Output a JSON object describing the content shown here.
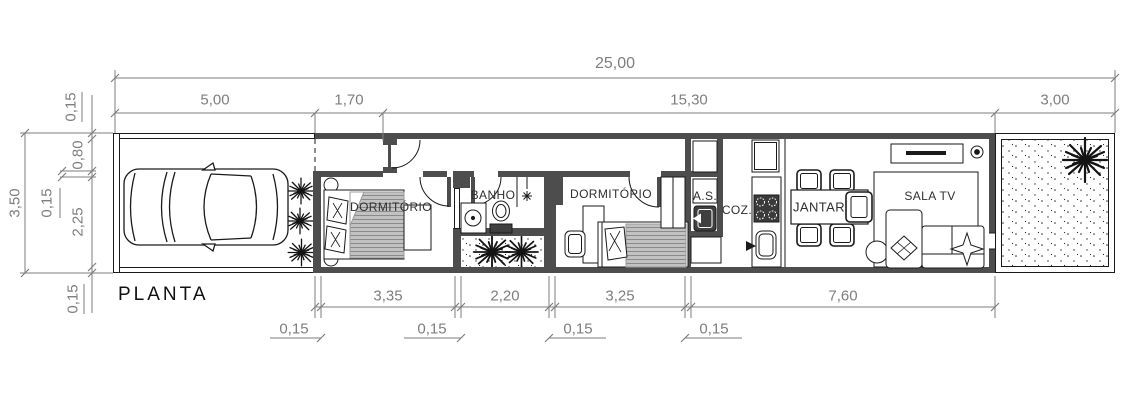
{
  "title": "PLANTA",
  "colors": {
    "wall_fill": "#4d4d4d",
    "dimension_gray": "#7e7e7e",
    "line_black": "#1a1a1a",
    "bed_gray": "#c2c2c2"
  },
  "dimensions": {
    "overall_width": "25,00",
    "top": [
      "5,00",
      "1,70",
      "15,30",
      "3,00"
    ],
    "left": {
      "total": "3,50",
      "wall_top": "0,15",
      "hall": "0,80",
      "wall_inner": "0,15",
      "rooms_depth": "2,25",
      "wall_bottom": "0,15"
    },
    "bottom": [
      "3,35",
      "2,20",
      "3,25",
      "7,60"
    ],
    "bottom_walls": [
      "0,15",
      "0,15",
      "0,15",
      "0,15"
    ]
  },
  "rooms": {
    "dormitorio_1": "DORMITÓRIO",
    "banho": "BANHO",
    "dormitorio_2": "DORMITÓRIO",
    "area_servico": "A.S.",
    "cozinha": "COZ.",
    "jantar": "JANTAR",
    "sala_tv": "SALA TV"
  }
}
